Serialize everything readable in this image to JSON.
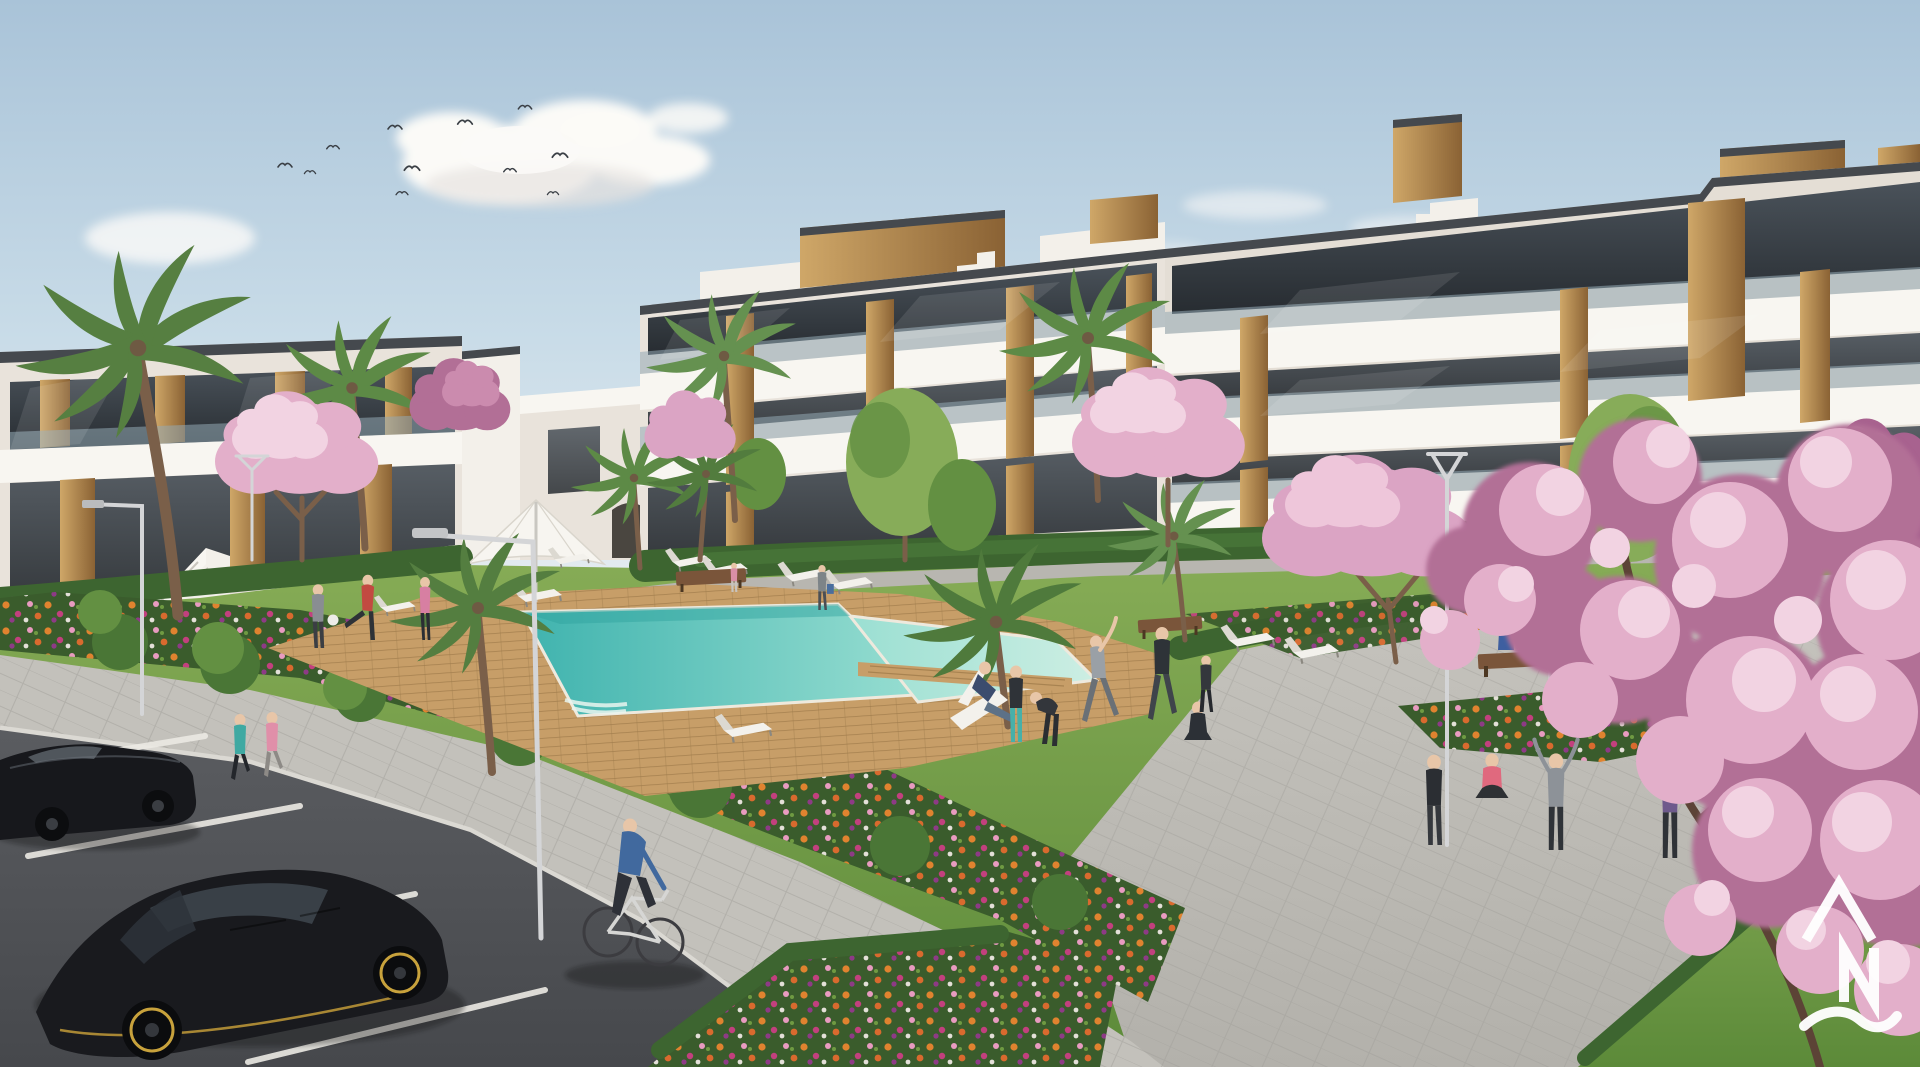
{
  "meta": {
    "title": "New-build residential complex with communal pool garden — exterior 3D architectural rendering",
    "scene_type": "architectural visualization",
    "view": "elevated three-quarter view over courtyard, parking lane in foreground"
  },
  "watermark": {
    "letters": "AN",
    "symbol": "caret-A above N with wave underline",
    "color": "#ffffff",
    "position": "bottom-right"
  },
  "palette": {
    "sky_top": "#a9c3d8",
    "sky_mid": "#c9dce8",
    "sky_horizon": "#e9eef1",
    "cloud": "#fbfaf7",
    "building_white": "#f8f6f1",
    "building_recess": "#e9e3db",
    "glass_top": "#4a525a",
    "glass_bottom": "#272c31",
    "glass_rail": "#93a9b4",
    "wood_light": "#cfa768",
    "wood_dark": "#8a6234",
    "roof_trim": "#45494e",
    "hedge": "#3d6530",
    "lawn_light": "#88ad57",
    "lawn_dark": "#5c8a39",
    "deck": "#c79e68",
    "pool_deep": "#3fb3ae",
    "pool_shallow": "#9adfd2",
    "pool_pale": "#cdeee3",
    "path_gray": "#c3c1bb",
    "plaza_light": "#c6c4be",
    "plaza_dark": "#b3b1ab",
    "asphalt_light": "#5a5c60",
    "asphalt_dark": "#46484c",
    "parking_line": "#eceae4",
    "flower_orange": "#e0832f",
    "flower_magenta": "#c2407e",
    "flower_pink": "#e89bc0",
    "blossom_light": "#f2d3e2",
    "blossom_mid": "#e3afca",
    "blossom_deep": "#cb8bae",
    "blossom_shade": "#b26f96",
    "branch_brown": "#5c4336",
    "palm_green": "#5d8a46",
    "car_black": "#1a1b1f",
    "car_accent_yellow": "#c8a23c"
  },
  "scene": {
    "sky": {
      "description": "pale blue sky with soft cumulus clouds",
      "cloud_count": 6,
      "bird_count": 11
    },
    "buildings": [
      {
        "name": "left-wing",
        "floors": 2,
        "style": "white modern block, dark glazing, timber slat accents, external staircase"
      },
      {
        "name": "far-center-block",
        "floors": 3,
        "style": "white terraces, glass balustrades, timber piers, rooftop timber volumes, stepped parapets"
      },
      {
        "name": "right-block",
        "floors": 3,
        "style": "long stepped white terraces, timber feature towers, staircase parapet"
      }
    ],
    "amenities": {
      "pool": "L-shaped turquoise swimming pool with timber sun deck and timber crossing",
      "parasol_count": 1,
      "sun_lounger_count": 10,
      "deck_chair_count": 1,
      "bench_count": 3,
      "street_lamp_count": 5
    },
    "vegetation": {
      "palm_count": 9,
      "blossom_tree_count": 7,
      "green_tree_count": 6,
      "flower_beds": "mixed orange, pink and magenta planting bands",
      "hedges": "clipped box hedging along buildings and paths",
      "lawn": "communal lawn"
    },
    "vehicles": [
      {
        "type": "hatchback",
        "color": "black",
        "body_hex": "#191a1e",
        "accent": "yellow rims and skirt line"
      },
      {
        "type": "sedan",
        "color": "black",
        "body_hex": "#17181c",
        "accent": ""
      }
    ],
    "people": [
      {
        "id": "jogger-left",
        "activity": "jogging on path",
        "top_color": "#3fa9a2",
        "bottom_color": "#23262b"
      },
      {
        "id": "jogger-right",
        "activity": "jogging on path",
        "top_color": "#e08fa9",
        "bottom_color": "#8d8a86"
      },
      {
        "id": "cyclist",
        "activity": "riding bicycle",
        "top_color": "#41699e",
        "bottom_color": "#2e3138"
      },
      {
        "id": "man-with-ball",
        "activity": "standing on lawn",
        "top_color": "#898d92",
        "bottom_color": "#3b3e43"
      },
      {
        "id": "man-kicking-ball",
        "activity": "kicking football",
        "top_color": "#c24a41",
        "bottom_color": "#2e3237"
      },
      {
        "id": "woman-pink",
        "activity": "standing on lawn",
        "top_color": "#d77fa2",
        "bottom_color": "#2b2e33"
      },
      {
        "id": "deckchair-man",
        "activity": "lounging in deck chair",
        "top_color": "#3c4c6e",
        "bottom_color": "#5d7187"
      },
      {
        "id": "teal-leggings",
        "activity": "exercising",
        "top_color": "#2f3338",
        "bottom_color": "#47b0a9"
      },
      {
        "id": "hoodie-bent",
        "activity": "stretching forward",
        "top_color": "#33363b",
        "bottom_color": "#2b2e32"
      },
      {
        "id": "stretch-gray",
        "activity": "side stretch, arm up",
        "top_color": "#9aa0a6",
        "bottom_color": "#6a7076"
      },
      {
        "id": "navy-shorts-man",
        "activity": "lunging exercise",
        "top_color": "#2e3338",
        "bottom_color": "#3f444b"
      },
      {
        "id": "yoga-seated",
        "activity": "seated yoga",
        "top_color": "#2c3036",
        "bottom_color": "#2c3036"
      },
      {
        "id": "plaza-woman-black",
        "activity": "standing on plaza",
        "top_color": "#2b2e33",
        "bottom_color": "#35383d"
      },
      {
        "id": "plaza-pink-seated",
        "activity": "seated cross-legged",
        "top_color": "#e0697e",
        "bottom_color": "#2e3134"
      },
      {
        "id": "plaza-stretcher",
        "activity": "arms raised stretch",
        "top_color": "#8d9298",
        "bottom_color": "#2f3338"
      },
      {
        "id": "arms-up-purple",
        "activity": "both arms raised",
        "top_color": "#6e5a8c",
        "bottom_color": "#2f3237"
      },
      {
        "id": "walker-with-bag",
        "activity": "walking with tote bag",
        "top_color": "#7d8488",
        "bottom_color": "#4b4f55"
      },
      {
        "id": "child-pink",
        "activity": "standing near bench",
        "top_color": "#d98fa6",
        "bottom_color": "#c9c4be"
      },
      {
        "id": "bench-sitter-blue",
        "activity": "sitting on bench",
        "top_color": "#3e5fa0",
        "bottom_color": "#2c2f34"
      },
      {
        "id": "bench-sitter-pink",
        "activity": "sitting on bench",
        "top_color": "#d4758f",
        "bottom_color": "#2c2f34"
      },
      {
        "id": "plaza-walker-dark",
        "activity": "walking on plaza",
        "top_color": "#34373c",
        "bottom_color": "#26292e"
      }
    ]
  }
}
